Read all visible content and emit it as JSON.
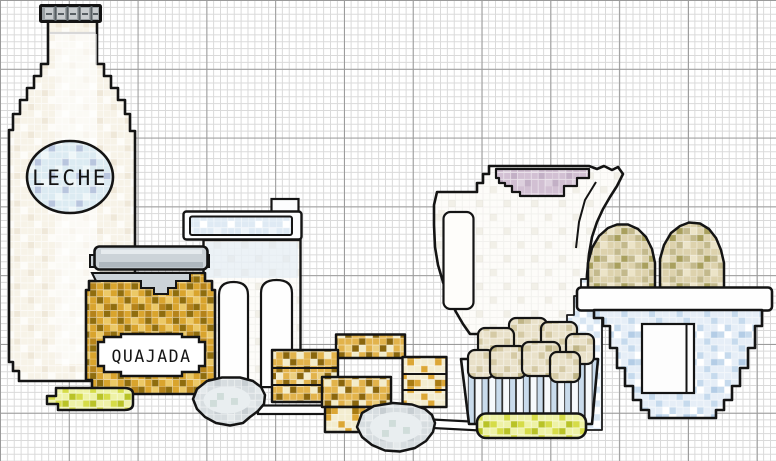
{
  "scene": {
    "kind": "cross-stitch embroidery pattern on grid paper",
    "objects": [
      "milk-bottle",
      "bottle-cap",
      "milk-label",
      "white-tub",
      "tub-lid",
      "curd-jar",
      "jar-lid",
      "jar-label",
      "butter-stick",
      "measuring-scoop",
      "biscuit-stack",
      "serving-spoon",
      "milk-pitcher",
      "pitcher-drink",
      "milk-stream",
      "sugar-lump-basket",
      "basket-base",
      "eggs",
      "egg-bowl"
    ]
  },
  "labels": {
    "milk_bottle": "LECHE",
    "curd_jar": "QUAJADA"
  },
  "colors": {
    "grid_minor": "#dadada",
    "grid_major": "#9a9a9a",
    "outline": "#141414",
    "ivory": "#f7f3e8",
    "cap": "#9aa0a3",
    "cap_light": "#c9cdcf",
    "cap_dark": "#585f63",
    "label_blue": "#dcebf2",
    "label_shade": "#b9c6de",
    "jar_lid": "#ccd3d8",
    "jar_lid_dark": "#aeb7be",
    "honey": "#d9a42d",
    "honey_dark": "#8f6d0e",
    "honey_deep": "#b5831a",
    "honey_light": "#ecc967",
    "tub_blue": "#dfeaf4",
    "biscuit": "#e2b34b",
    "biscuit_dark": "#8a660d",
    "biscuit_cream": "#f3ecca",
    "biscuit_light": "#eccf7f",
    "pale": "#f3edd0",
    "gold": "#dca735",
    "gold_deep": "#a87b12",
    "butter": "#eef2a6",
    "butter_mid": "#d6dc48",
    "butter_deep": "#b9c327",
    "spoon_grey": "#d7dde0",
    "spoon_light": "#e9eef0",
    "spoon_teal": "#c9d8d4",
    "mauve": "#d2c0d3",
    "mauve_light": "#ddd0de",
    "mauve_deep": "#c3b0c6",
    "stream": "#d7e5f2",
    "egg": "#ddd2ad",
    "egg_mid": "#c3b98c",
    "egg_dark": "#a9a05e",
    "egg_cream": "#ece4c8",
    "lump": "#e9e1c9",
    "lump_mid": "#d5caa5",
    "lump_deep": "#c0b587",
    "bowl_blue": "#e6eef7",
    "bowl_mid": "#c6daed",
    "bowl_deep": "#b4cde6",
    "stripe_blue": "#c9dbec",
    "white": "#ffffff"
  }
}
